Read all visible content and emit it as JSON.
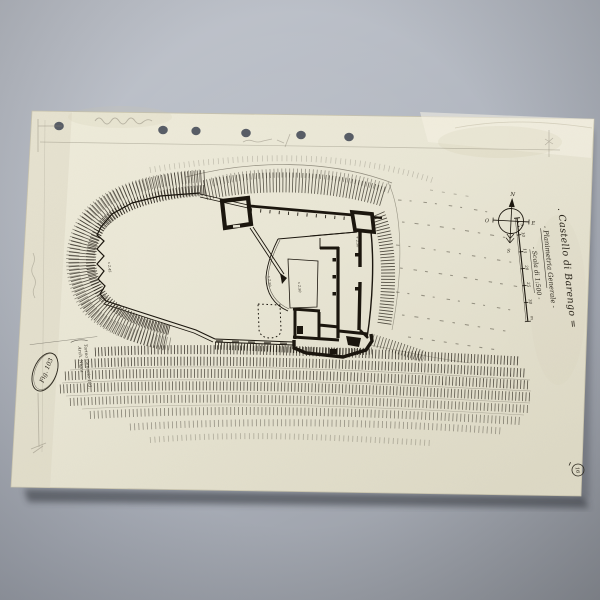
{
  "photo": {
    "backdrop_color": "#aeb3bd",
    "shadow_color": "#2e3138"
  },
  "sheet": {
    "paper_color": "#e9e6d5",
    "ink_color": "#1b160e",
    "pencil_color": "#8a8475",
    "title_block": {
      "line1": ". Castello di Barengo =",
      "line2": "- Planimetria Generale -",
      "line3": "- Scala di 1:500 -"
    },
    "compass": {
      "north": "N",
      "east": "E",
      "south": "S",
      "west": "O"
    },
    "scale_bar": {
      "labels": [
        "5",
        "10",
        "15",
        "20",
        "25",
        "30"
      ],
      "unit": "m"
    },
    "spot_heights": [
      "x 2.50",
      "x 2.50",
      "+ 2.50",
      "x 2.45"
    ],
    "stamp": {
      "text": "Fig. 103"
    },
    "corner_mark": "16",
    "signature": {
      "line1": "Torino Gennaio 193.",
      "line2": "Arch. Nigra"
    }
  }
}
